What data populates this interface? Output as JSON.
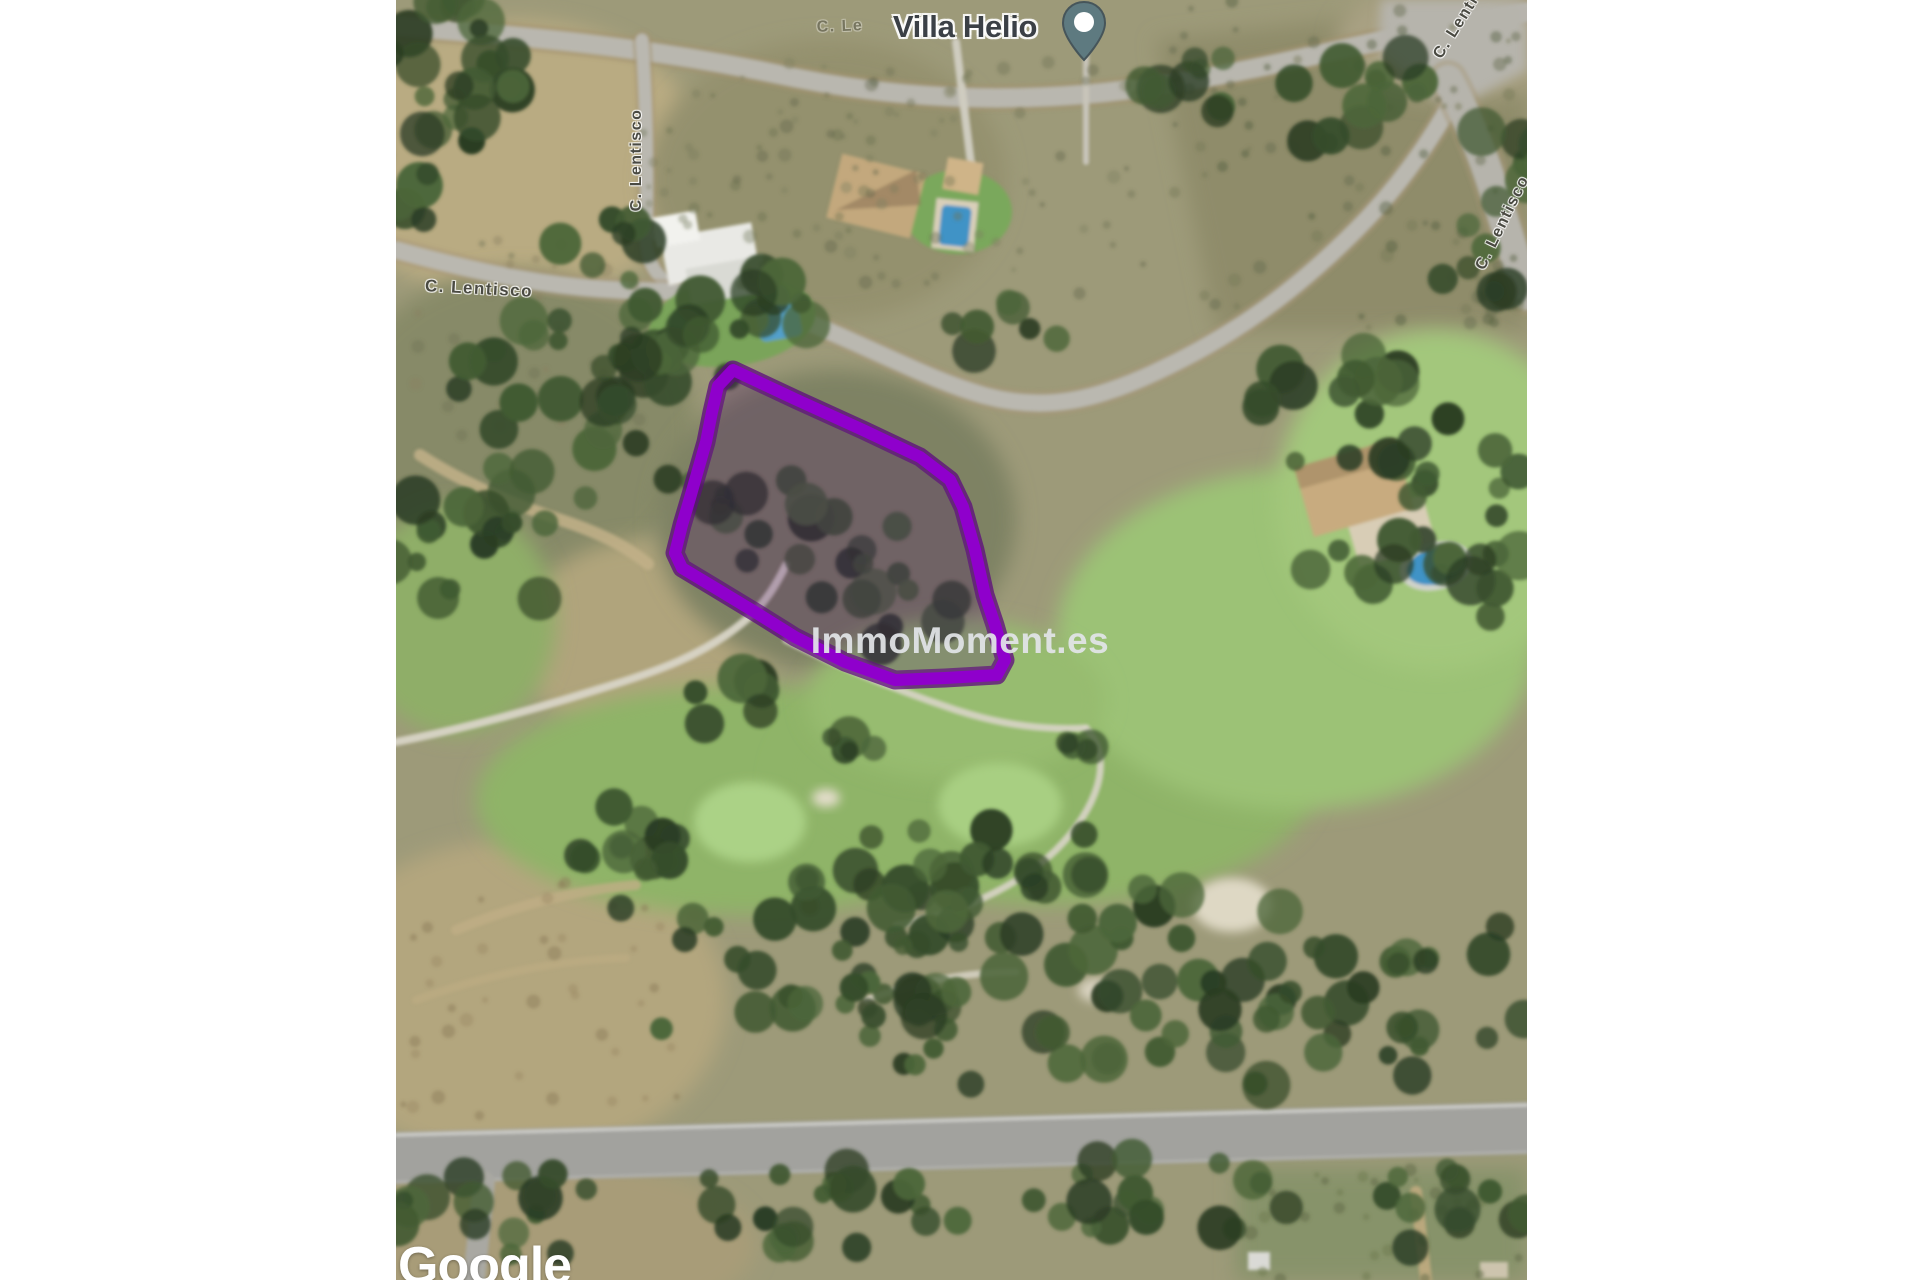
{
  "map": {
    "place_label": "Villa Helio",
    "watermark": "ImmoMoment.es",
    "attribution": "Google",
    "street_labels": [
      {
        "id": "horizontal",
        "text": "C. Lentisco"
      },
      {
        "id": "vertical",
        "text": "C. Lentisco"
      },
      {
        "id": "right-edge",
        "text": "C. Lentisco"
      },
      {
        "id": "top-right",
        "text": "C. Lentisco"
      },
      {
        "id": "faint-top",
        "text": "C. Le"
      }
    ],
    "colors": {
      "parcel_outline": "#8f00cc",
      "parcel_fill": "rgba(70,0,110,0.32)",
      "pin": "#5e7a80",
      "place_label": "#3b4046",
      "street_label": "#4a4a42",
      "watermark": "rgba(226,228,232,0.93)",
      "attribution": "#ffffff"
    }
  }
}
